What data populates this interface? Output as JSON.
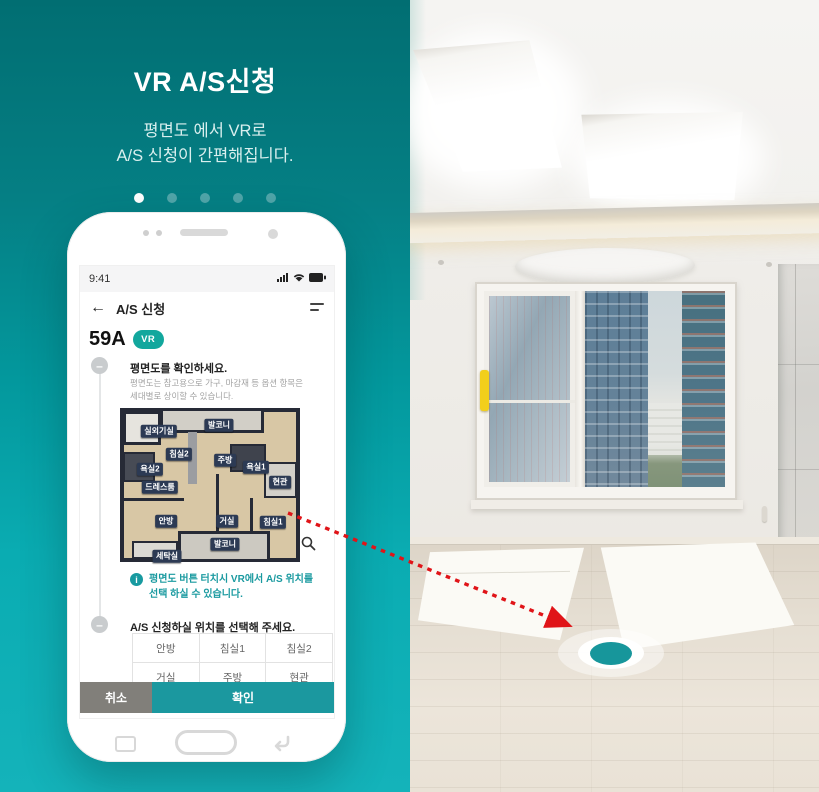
{
  "intro": {
    "title": "VR A/S신청",
    "subtitle_line1": "평면도 에서 VR로",
    "subtitle_line2": "A/S 신청이 간편해집니다.",
    "pagination": {
      "total": 5,
      "active_index": 0
    }
  },
  "phone": {
    "status_bar": {
      "time": "9:41",
      "icons": [
        "signal-icon",
        "wifi-icon",
        "battery-icon"
      ]
    },
    "app_bar": {
      "back_glyph": "←",
      "title": "A/S 신청",
      "menu_icon": "menu-icon"
    },
    "unit": {
      "label": "59A",
      "badge": "VR"
    },
    "step1": {
      "bullet": "–",
      "title": "평면도를 확인하세요.",
      "desc1": "평면도는 참고용으로 가구, 마감재 등 옵션 항목은",
      "desc2": "세대별로 상이할 수 있습니다."
    },
    "floor_plan": {
      "rooms": [
        "실외기실",
        "발코니",
        "침실2",
        "주방",
        "욕실2",
        "욕실1",
        "현관",
        "드레스룸",
        "안방",
        "거실",
        "침실1",
        "발코니",
        "세탁실"
      ],
      "zoom_icon": "magnifier"
    },
    "info": {
      "icon": "i",
      "line1": "평면도 버튼 터치시 VR에서 A/S 위치를",
      "line2": "선택 하실 수 있습니다."
    },
    "step2": {
      "bullet": "–",
      "title": "A/S 신청하실 위치를 선택해 주세요."
    },
    "table": {
      "rows": [
        [
          "안방",
          "침실1",
          "침실2"
        ],
        [
          "거실",
          "주방",
          "현관"
        ]
      ]
    },
    "actions": {
      "cancel": "취소",
      "confirm": "확인"
    }
  },
  "colors": {
    "panel_top": "#016e72",
    "panel_bottom": "#14b3ba",
    "accent_teal": "#1a9aa0",
    "vr_badge": "#12a79d",
    "confirm_button": "#1b989f",
    "cancel_button": "#817f7a",
    "room_tag_navy": "#2c3a54",
    "arrow_red": "#e01418",
    "target_teal": "#17969b"
  }
}
